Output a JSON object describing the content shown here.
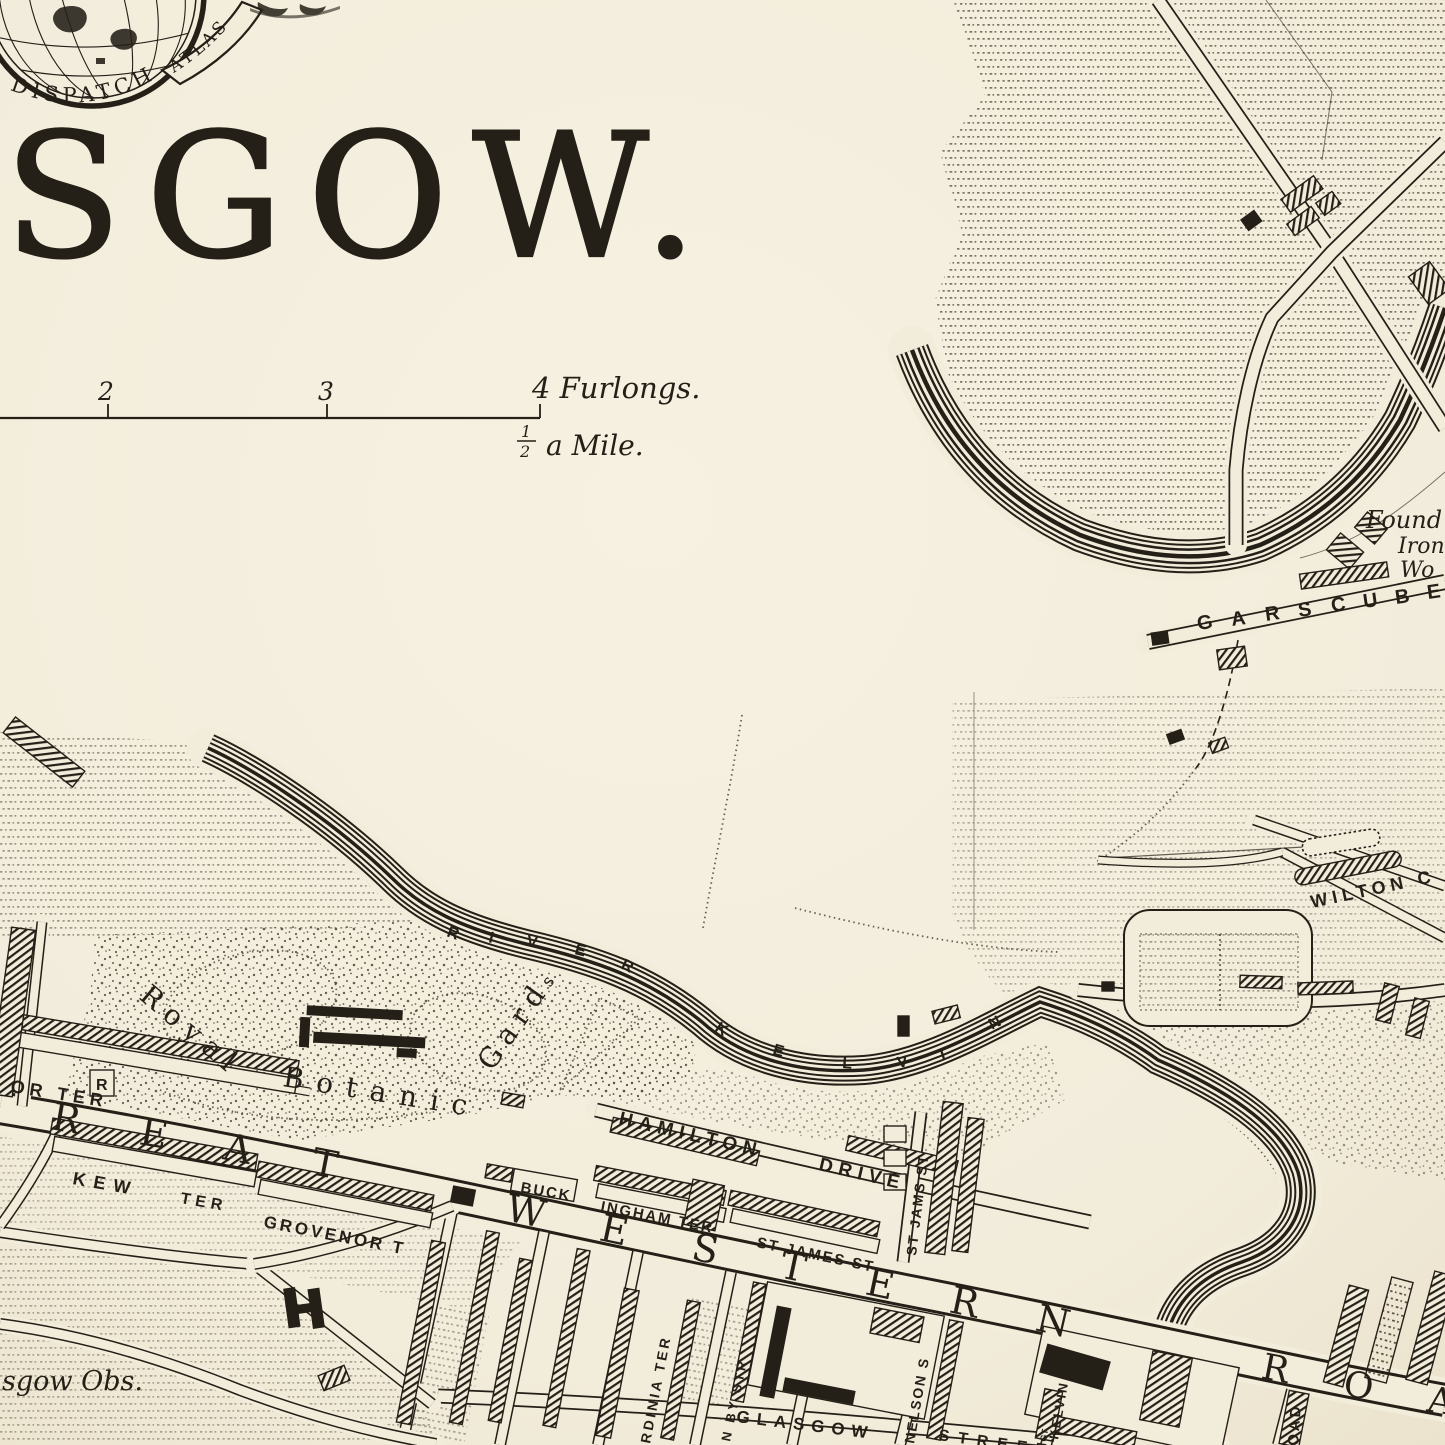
{
  "colors": {
    "paper": "#f2ecdb",
    "ink": "#241f17",
    "dots": "#544c3c"
  },
  "emblem": {
    "globe_text": "DISPATCH",
    "ribbon_text": "ATLAS"
  },
  "title": "SGOW.",
  "scale_bar": {
    "tick_2": "2",
    "tick_3": "3",
    "tick_4_label": "4 Furlongs.",
    "half_numerator": "1",
    "half_denominator": "2",
    "half_mile_label": "a Mile."
  },
  "river": {
    "river_letters": [
      "R",
      "I",
      "V",
      "E",
      "R"
    ],
    "kelvin_letters": [
      "K",
      "E",
      "L",
      "V",
      "I",
      "N"
    ]
  },
  "great_western_road": {
    "great": [
      "R",
      "E",
      "A",
      "T"
    ],
    "western": [
      "W",
      "E",
      "S",
      "T",
      "E",
      "R",
      "N"
    ],
    "road": [
      "R",
      "O",
      "A"
    ]
  },
  "garscube": {
    "letters": [
      "G",
      "A",
      "R",
      "S",
      "C",
      "U",
      "B",
      "E"
    ]
  },
  "labels": {
    "foundry_1": "Found",
    "foundry_2": "Iron",
    "foundry_3": "Wo",
    "wilton": "WILTON C",
    "or_ter": "OR TER",
    "r_box": "R",
    "kew": "KEW",
    "ter": "TER",
    "grovenor": "GROVENOR T",
    "buck": "BUCK",
    "ingham": "INGHAM TER",
    "st_james": "ST JAMES ST",
    "st_jams_vert": "ST JAMS ST",
    "hamilton": "HAMILTON",
    "drive": "DRIVE",
    "royal": "Royal",
    "botanic": "Botanic",
    "gardens": "Gard",
    "gardens_sup": "s",
    "glasgow_st": "GLASGOW",
    "street": "STREET",
    "rdinia": "RDINIA TER",
    "granby": "N BY STR",
    "nelson": "NELSON S",
    "kelvin_t": "KELVIN T",
    "kelvin_gt": "GT",
    "oad": "OAD",
    "obs": "sgow Obs."
  }
}
